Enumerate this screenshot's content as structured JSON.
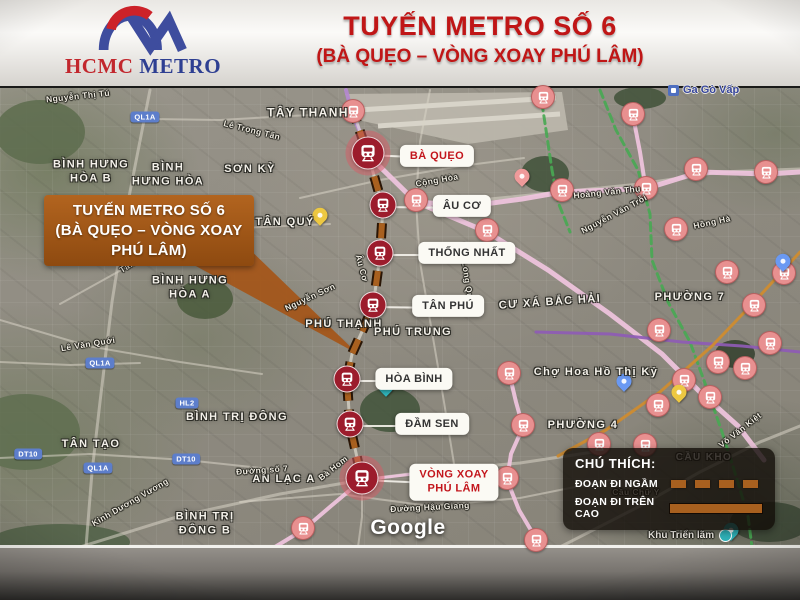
{
  "header": {
    "logo_text_red": "HCMC",
    "logo_text_blue": "METRO",
    "title_line1": "TUYẾN METRO SỐ 6",
    "title_line2": "(BÀ QUẸO – VÒNG XOAY PHÚ LÂM)",
    "accent_red": "#c01616",
    "logo_blue": "#3e4d9e",
    "logo_red": "#cc2229"
  },
  "callout": {
    "line1": "TUYẾN METRO SỐ 6",
    "line2": "(BÀ QUẸO – VÒNG XOAY",
    "line3": "PHÚ LÂM)",
    "bg": "#a3571c"
  },
  "route": {
    "name": "Tuyến Metro Số 6 (Bà Quẹo – Vòng Xoay Phú Lâm)",
    "color": "#a8601f",
    "casing": "#2a1606",
    "path": [
      [
        352,
        106
      ],
      [
        368,
        153
      ],
      [
        383,
        205
      ],
      [
        380,
        253
      ],
      [
        373,
        305
      ],
      [
        352,
        352
      ],
      [
        347,
        379
      ],
      [
        350,
        424
      ],
      [
        362,
        478
      ]
    ],
    "stations": [
      {
        "label": "BÀ QUẸO",
        "x": 368,
        "y": 153,
        "lx": 437,
        "ly": 156,
        "red": true,
        "major": true
      },
      {
        "label": "ÂU CƠ",
        "x": 383,
        "y": 205,
        "lx": 462,
        "ly": 206,
        "red": false,
        "major": false
      },
      {
        "label": "THỐNG NHẤT",
        "x": 380,
        "y": 253,
        "lx": 467,
        "ly": 253,
        "red": false,
        "major": false
      },
      {
        "label": "TÂN PHÚ",
        "x": 373,
        "y": 305,
        "lx": 448,
        "ly": 306,
        "red": false,
        "major": false
      },
      {
        "label": "HÒA BÌNH",
        "x": 347,
        "y": 379,
        "lx": 414,
        "ly": 379,
        "red": false,
        "major": false
      },
      {
        "label": "ĐẦM SEN",
        "x": 350,
        "y": 424,
        "lx": 432,
        "ly": 424,
        "red": false,
        "major": false
      },
      {
        "label": "VÒNG XOAY\nPHÚ LÂM",
        "x": 362,
        "y": 478,
        "lx": 454,
        "ly": 482,
        "red": true,
        "major": true
      }
    ]
  },
  "legend": {
    "title": "CHÚ THÍCH:",
    "items": [
      {
        "label": "ĐOẠN ĐI NGẦM",
        "style": "dashed"
      },
      {
        "label": "ĐOẠN ĐI TRÊN CAO",
        "style": "solid"
      }
    ]
  },
  "map": {
    "attribution": "Google",
    "transit_poi": {
      "text": "Ga Gò Vấp",
      "x": 707,
      "y": 91
    },
    "exhibit_poi": {
      "text": "Khu Triển lãm",
      "x": 694,
      "y": 537
    },
    "area_labels": [
      {
        "text": "TÂY THANH",
        "x": 308,
        "y": 113,
        "s": 12
      },
      {
        "text": "SƠN KỲ",
        "x": 250,
        "y": 170,
        "s": 11
      },
      {
        "text": "BÌNH HƯNG\nHÒA B",
        "x": 91,
        "y": 172,
        "s": 11
      },
      {
        "text": "BÌNH\nHƯNG HÒA",
        "x": 168,
        "y": 175,
        "s": 11
      },
      {
        "text": "BÌNH HƯNG\nHÒA A",
        "x": 190,
        "y": 288,
        "s": 11
      },
      {
        "text": "TÂN QUÝ",
        "x": 285,
        "y": 223,
        "s": 11
      },
      {
        "text": "PHÚ THẠNH",
        "x": 344,
        "y": 325,
        "s": 11
      },
      {
        "text": "PHÚ TRUNG",
        "x": 413,
        "y": 333,
        "s": 11
      },
      {
        "text": "CƯ XÁ BẮC HẢI",
        "x": 550,
        "y": 303,
        "s": 11,
        "rot": -4
      },
      {
        "text": "PHƯỜNG 7",
        "x": 690,
        "y": 298,
        "s": 11
      },
      {
        "text": "Chợ Hoa Hồ Thị Kỷ",
        "x": 596,
        "y": 373,
        "s": 11
      },
      {
        "text": "PHƯỜNG 4",
        "x": 583,
        "y": 426,
        "s": 11
      },
      {
        "text": "TÂN TẠO",
        "x": 91,
        "y": 445,
        "s": 11
      },
      {
        "text": "BÌNH TRỊ ĐÔNG",
        "x": 237,
        "y": 418,
        "s": 11
      },
      {
        "text": "AN LẠC A",
        "x": 284,
        "y": 480,
        "s": 11
      },
      {
        "text": "BÌNH TRỊ\nĐÔNG B",
        "x": 205,
        "y": 524,
        "s": 11
      },
      {
        "text": "CẦU KHO",
        "x": 704,
        "y": 458,
        "s": 10
      }
    ],
    "road_labels": [
      {
        "text": "Nguyễn Thị Tú",
        "x": 78,
        "y": 96,
        "rot": -6
      },
      {
        "text": "Lê Trọng Tấn",
        "x": 252,
        "y": 130,
        "rot": 14
      },
      {
        "text": "Cộng Hòa",
        "x": 437,
        "y": 180,
        "rot": -10
      },
      {
        "text": "Hoàng Văn Thụ",
        "x": 607,
        "y": 192,
        "rot": -6
      },
      {
        "text": "Nguyễn Văn Trỗi",
        "x": 614,
        "y": 214,
        "rot": -28
      },
      {
        "text": "Hồng Hà",
        "x": 712,
        "y": 222,
        "rot": -12
      },
      {
        "text": "Tân Kỳ Tân Quý",
        "x": 150,
        "y": 252,
        "rot": -32
      },
      {
        "text": "Nguyễn Sơn",
        "x": 310,
        "y": 297,
        "rot": -25
      },
      {
        "text": "Lạc Long Quân",
        "x": 467,
        "y": 276,
        "rot": 82
      },
      {
        "text": "Âu Cơ",
        "x": 362,
        "y": 268,
        "rot": 75
      },
      {
        "text": "Lê Văn Quới",
        "x": 88,
        "y": 344,
        "rot": -9
      },
      {
        "text": "Đường số 7",
        "x": 262,
        "y": 470,
        "rot": -4
      },
      {
        "text": "Bà Hom",
        "x": 333,
        "y": 468,
        "rot": -38
      },
      {
        "text": "Kinh Dương Vương",
        "x": 130,
        "y": 502,
        "rot": -30
      },
      {
        "text": "Đường Hậu Giang",
        "x": 430,
        "y": 507,
        "rot": -3
      },
      {
        "text": "Võ Văn Kiệt",
        "x": 740,
        "y": 430,
        "rot": -38
      },
      {
        "text": "Cầu Chữ Y",
        "x": 636,
        "y": 492,
        "rot": 0
      }
    ],
    "road_badges": [
      {
        "text": "QL1A",
        "x": 145,
        "y": 117
      },
      {
        "text": "QL1A",
        "x": 100,
        "y": 363
      },
      {
        "text": "QL1A",
        "x": 98,
        "y": 468
      },
      {
        "text": "DT10",
        "x": 28,
        "y": 454
      },
      {
        "text": "DT10",
        "x": 186,
        "y": 459
      },
      {
        "text": "HL2",
        "x": 187,
        "y": 403
      }
    ],
    "context_stations": [
      [
        353,
        111
      ],
      [
        543,
        97
      ],
      [
        633,
        114
      ],
      [
        416,
        200
      ],
      [
        562,
        190
      ],
      [
        646,
        188
      ],
      [
        696,
        169
      ],
      [
        766,
        172
      ],
      [
        676,
        229
      ],
      [
        487,
        230
      ],
      [
        727,
        272
      ],
      [
        784,
        273
      ],
      [
        754,
        305
      ],
      [
        659,
        330
      ],
      [
        770,
        343
      ],
      [
        718,
        362
      ],
      [
        745,
        368
      ],
      [
        684,
        380
      ],
      [
        710,
        397
      ],
      [
        658,
        405
      ],
      [
        509,
        373
      ],
      [
        523,
        425
      ],
      [
        507,
        478
      ],
      [
        599,
        444
      ],
      [
        645,
        445
      ],
      [
        303,
        528
      ],
      [
        536,
        540
      ]
    ],
    "pins": [
      {
        "x": 320,
        "y": 222,
        "color": "#edc842"
      },
      {
        "x": 679,
        "y": 399,
        "color": "#edc842"
      },
      {
        "x": 522,
        "y": 183,
        "color": "#ef9a9a"
      },
      {
        "x": 386,
        "y": 393,
        "color": "#2fb3ba"
      },
      {
        "x": 731,
        "y": 537,
        "color": "#2fb3ba"
      },
      {
        "x": 624,
        "y": 388,
        "color": "#6a99f2"
      },
      {
        "x": 783,
        "y": 268,
        "color": "#6a99f2"
      }
    ],
    "context_lines": [
      {
        "color": "#b488cf",
        "width": 4,
        "points": [
          [
            346,
            88
          ],
          [
            352,
            111
          ],
          [
            362,
            135
          ],
          [
            368,
            153
          ]
        ]
      },
      {
        "color": "#f0c4de",
        "width": 5,
        "points": [
          [
            368,
            153
          ],
          [
            416,
            200
          ],
          [
            487,
            230
          ],
          [
            548,
            268
          ],
          [
            610,
            312
          ],
          [
            662,
            352
          ],
          [
            700,
            390
          ],
          [
            738,
            424
          ],
          [
            764,
            458
          ]
        ]
      },
      {
        "color": "#f0c4de",
        "width": 5,
        "points": [
          [
            416,
            200
          ],
          [
            470,
            204
          ],
          [
            522,
            197
          ],
          [
            562,
            190
          ],
          [
            612,
            188
          ],
          [
            648,
            186
          ],
          [
            700,
            170
          ],
          [
            768,
            172
          ],
          [
            800,
            170
          ]
        ]
      },
      {
        "color": "#f0c4de",
        "width": 4,
        "points": [
          [
            633,
            114
          ],
          [
            640,
            150
          ],
          [
            646,
            188
          ]
        ]
      },
      {
        "color": "#f0c4de",
        "width": 4,
        "points": [
          [
            507,
            362
          ],
          [
            516,
            400
          ],
          [
            523,
            425
          ],
          [
            511,
            452
          ],
          [
            507,
            478
          ],
          [
            519,
            508
          ],
          [
            538,
            540
          ],
          [
            545,
            545
          ]
        ]
      },
      {
        "color": "#f0c4de",
        "width": 4,
        "points": [
          [
            362,
            478
          ],
          [
            331,
            504
          ],
          [
            303,
            528
          ],
          [
            270,
            548
          ]
        ]
      },
      {
        "color": "#f0c4de",
        "width": 3,
        "points": [
          [
            362,
            478
          ],
          [
            430,
            470
          ],
          [
            470,
            474
          ],
          [
            507,
            478
          ]
        ]
      },
      {
        "color": "#49a854",
        "width": 3,
        "dash": "8 5",
        "points": [
          [
            600,
            88
          ],
          [
            616,
            128
          ],
          [
            638,
            168
          ],
          [
            650,
            212
          ],
          [
            652,
            258
          ],
          [
            668,
            300
          ],
          [
            690,
            340
          ],
          [
            706,
            384
          ],
          [
            722,
            430
          ],
          [
            736,
            474
          ],
          [
            748,
            514
          ],
          [
            752,
            545
          ]
        ]
      },
      {
        "color": "#49a854",
        "width": 3,
        "dash": "8 5",
        "points": [
          [
            540,
            88
          ],
          [
            546,
            128
          ],
          [
            552,
            168
          ],
          [
            558,
            200
          ],
          [
            570,
            230
          ]
        ]
      },
      {
        "color": "#8e5bb5",
        "width": 3,
        "points": [
          [
            536,
            330
          ],
          [
            610,
            332
          ],
          [
            682,
            340
          ],
          [
            742,
            344
          ],
          [
            800,
            350
          ]
        ]
      },
      {
        "color": "#d08c2e",
        "width": 3,
        "points": [
          [
            800,
            250
          ],
          [
            756,
            298
          ],
          [
            712,
            344
          ],
          [
            660,
            390
          ],
          [
            606,
            428
          ],
          [
            558,
            454
          ]
        ]
      }
    ],
    "roads": [
      {
        "w": 3,
        "points": [
          [
            150,
            88
          ],
          [
            128,
            200
          ],
          [
            112,
            300
          ],
          [
            100,
            400
          ],
          [
            92,
            470
          ],
          [
            86,
            545
          ]
        ]
      },
      {
        "w": 2,
        "points": [
          [
            0,
            318
          ],
          [
            88,
            344
          ],
          [
            180,
            360
          ],
          [
            262,
            372
          ]
        ]
      },
      {
        "w": 2,
        "points": [
          [
            60,
            302
          ],
          [
            150,
            252
          ],
          [
            240,
            226
          ],
          [
            330,
            222
          ]
        ]
      },
      {
        "w": 2,
        "points": [
          [
            300,
            196
          ],
          [
            380,
            178
          ],
          [
            460,
            164
          ],
          [
            524,
            156
          ]
        ]
      },
      {
        "w": 3,
        "points": [
          [
            480,
            198
          ],
          [
            560,
            190
          ],
          [
            640,
            182
          ],
          [
            720,
            170
          ],
          [
            800,
            167
          ]
        ]
      },
      {
        "w": 2,
        "points": [
          [
            0,
            456
          ],
          [
            90,
            452
          ],
          [
            186,
            458
          ],
          [
            280,
            468
          ]
        ]
      },
      {
        "w": 2,
        "points": [
          [
            240,
            500
          ],
          [
            340,
            492
          ],
          [
            430,
            504
          ],
          [
            520,
            496
          ],
          [
            610,
            478
          ]
        ]
      },
      {
        "w": 3,
        "points": [
          [
            80,
            545
          ],
          [
            180,
            514
          ],
          [
            280,
            492
          ],
          [
            362,
            478
          ],
          [
            440,
            468
          ],
          [
            520,
            461
          ],
          [
            600,
            449
          ]
        ]
      },
      {
        "w": 3,
        "points": [
          [
            560,
            545
          ],
          [
            640,
            504
          ],
          [
            700,
            470
          ],
          [
            760,
            440
          ],
          [
            800,
            424
          ]
        ]
      },
      {
        "w": 2,
        "points": [
          [
            353,
            111
          ],
          [
            290,
            114
          ],
          [
            220,
            118
          ],
          [
            150,
            117
          ]
        ]
      },
      {
        "w": 2,
        "points": [
          [
            362,
            478
          ],
          [
            362,
            515
          ],
          [
            358,
            545
          ]
        ]
      },
      {
        "w": 2,
        "points": [
          [
            430,
            88
          ],
          [
            420,
            140
          ],
          [
            416,
            200
          ],
          [
            420,
            260
          ],
          [
            432,
            330
          ],
          [
            444,
            400
          ],
          [
            455,
            468
          ]
        ]
      },
      {
        "w": 2,
        "points": [
          [
            0,
            360
          ],
          [
            70,
            363
          ],
          [
            140,
            361
          ]
        ]
      }
    ],
    "parks": [
      [
        390,
        408,
        30,
        22,
        "#41543a"
      ],
      [
        545,
        172,
        24,
        18,
        "#3f5138"
      ],
      [
        205,
        297,
        28,
        20,
        "#4a5a3c"
      ],
      [
        640,
        96,
        26,
        11,
        "#3f5138"
      ],
      [
        735,
        352,
        20,
        14,
        "#33402e"
      ],
      [
        40,
        130,
        45,
        32,
        "#5d6c4e"
      ],
      [
        25,
        430,
        55,
        38,
        "#5f6f50"
      ],
      [
        60,
        540,
        70,
        18,
        "#506046"
      ],
      [
        770,
        520,
        40,
        20,
        "#3a4534"
      ]
    ],
    "airport": {
      "poly": [
        [
          345,
          92
        ],
        [
          562,
          90
        ],
        [
          568,
          128
        ],
        [
          468,
          142
        ],
        [
          358,
          118
        ]
      ],
      "runways": [
        [
          [
            358,
            108
          ],
          [
            556,
            96
          ]
        ],
        [
          [
            378,
            124
          ],
          [
            560,
            112
          ]
        ]
      ]
    }
  }
}
